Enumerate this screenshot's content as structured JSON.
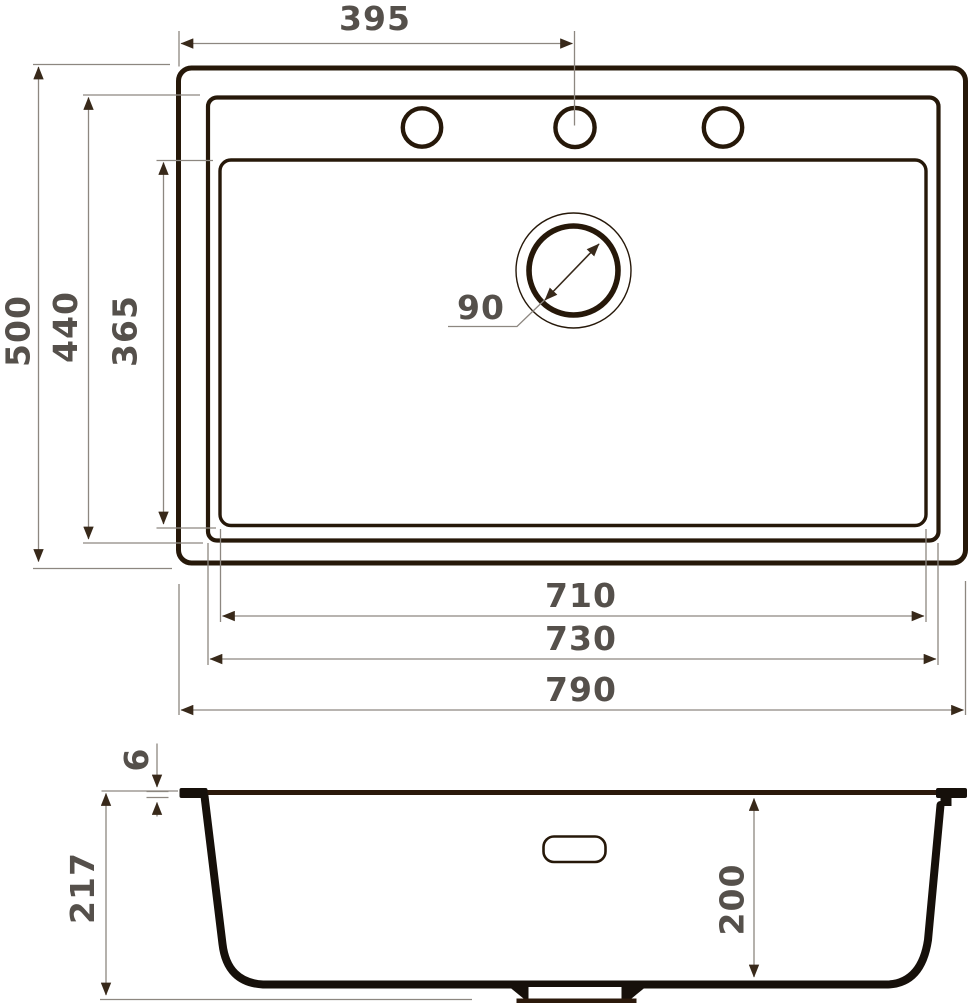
{
  "drawing": {
    "subject": "kitchen-sink-technical-drawing"
  },
  "top_view": {
    "dims": {
      "faucet_center_offset": "395",
      "overall_depth": "500",
      "rim_depth": "440",
      "bowl_depth": "365",
      "drain_diameter": "90",
      "bowl_width": "710",
      "rim_width": "730",
      "overall_width": "790"
    }
  },
  "side_view": {
    "dims": {
      "rim_thickness": "6",
      "overall_height": "217",
      "bowl_inner_depth": "200"
    }
  },
  "colors": {
    "outline": "#261809",
    "profile": "#16100a",
    "dimension_line": "#8d8780",
    "dimension_text": "#55504b",
    "background": "#ffffff"
  }
}
